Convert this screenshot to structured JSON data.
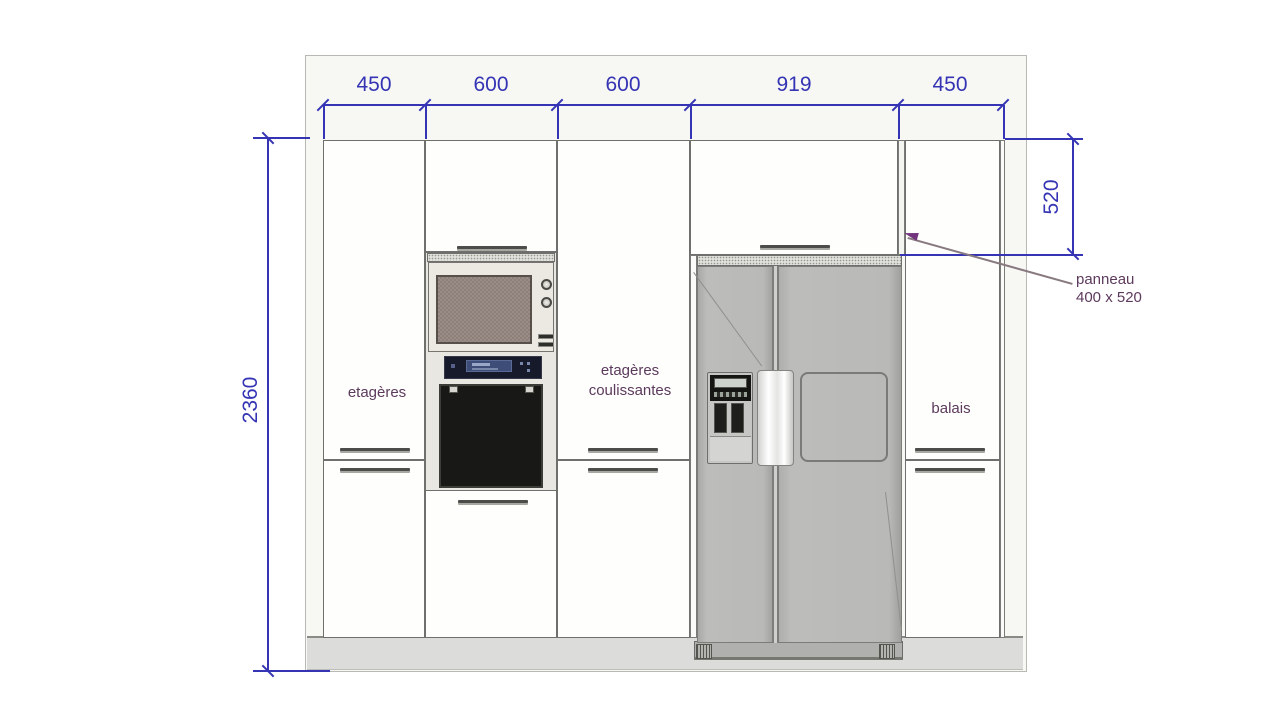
{
  "drawing": {
    "top_dimensions": [
      "450",
      "600",
      "600",
      "919",
      "450"
    ],
    "left_dimension": "2360",
    "right_dimension": "520",
    "callout": {
      "line1": "panneau",
      "line2": "400 x 520"
    },
    "cabinet_labels": {
      "left": "etagères",
      "middle_line1": "etagères",
      "middle_line2": "coulissantes",
      "right": "balais"
    },
    "colors": {
      "dimension_blue": "#3434b4",
      "label_purple": "#5c3a5c",
      "fridge_gray": "#b9b9b7",
      "cabinet_white": "#fdfdfc",
      "plinth_gray": "#dcdcda"
    }
  }
}
